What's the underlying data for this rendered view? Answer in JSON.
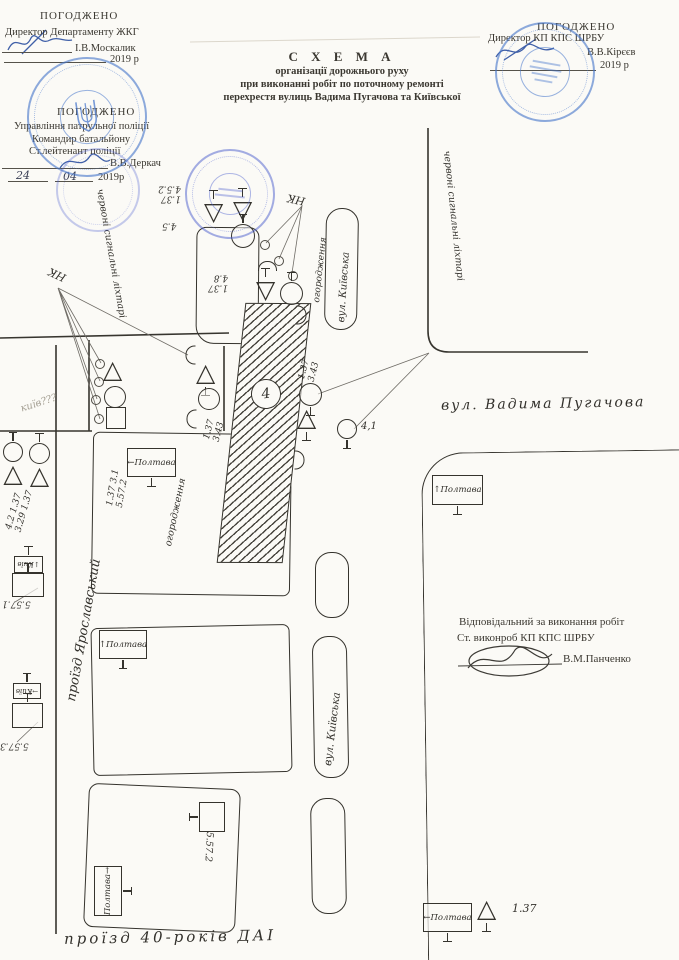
{
  "doc": {
    "approvals": {
      "zhkg": {
        "agreed": "ПОГОДЖЕНО",
        "role": "Директор Департаменту ЖКГ",
        "name": "І.В.Москалик",
        "year": "2019 р"
      },
      "police": {
        "agreed": "ПОГОДЖЕНО",
        "org": "Управління патрульної поліції",
        "role1": "Командир батальйону",
        "role2": "Ст.лейтенант поліції",
        "name": "В.В.Деркач",
        "day": "24",
        "month": "04",
        "year": "2019р"
      },
      "shrbu": {
        "agreed": "ПОГОДЖЕНО",
        "role": "Директор КП КПС ШРБУ",
        "name": "В.В.Кірєєв",
        "year": "2019 р"
      }
    },
    "title": {
      "l1": "С Х Е М А",
      "l2": "організації дорожнього руху",
      "l3": "при виконанні робіт по поточному ремонті",
      "l4": "перехрестя вулиць Вадима Пугачова та Київської"
    },
    "responsible": {
      "l1": "Відповідальний за виконання робіт",
      "l2": "Ст. виконроб КП КПС ШРБУ",
      "name": "В.М.Панченко"
    }
  },
  "streets": {
    "pugachova": "вул. Вадима Пугачова",
    "kyivska_top": "вул. Київська",
    "kyivska_mid": "вул. Київська",
    "yaroslavskyi": "проїзд Ярославський",
    "rokiv40": "проїзд 40-років ДАІ"
  },
  "annotations": {
    "red_lights_left": "червоні сигнальні ліхтарі",
    "red_lights_right": "червоні сигнальні ліхтарі",
    "fence_top": "огородження",
    "fence_left": "огородження",
    "nk_top": "НК",
    "nk_left": "НК",
    "pencil_note": "київ???",
    "zone_number": "4",
    "distance": "4,1"
  },
  "sign_labels": {
    "top_pair": [
      "1.37",
      "4.5.2"
    ],
    "top_circle": "4.5",
    "mid_pair": [
      "1.37",
      "4.8"
    ],
    "right_cluster": [
      "1.37",
      "3.43"
    ],
    "hatch_right": [
      "1.37",
      "3.43"
    ],
    "block_a": [
      "1.37  3.1",
      "5.57.2"
    ],
    "far_left": [
      "4.2  1.37",
      "3.29  1.37"
    ],
    "edge1": "5.57.1",
    "edge2": "5.57.3",
    "block_c": "5.57.2"
  },
  "signs": {
    "poltava_left": "←Полтава",
    "poltava_up_b": "↑Полтава",
    "poltava_up_r": "↑Полтава",
    "poltava_c": "Полтава→",
    "kyiv1": "↓Київ",
    "kyiv2": "→Київ"
  },
  "legend": {
    "poltava": "←Полтава",
    "tri_label": "1.37"
  },
  "colors": {
    "ink": "#35332d",
    "stamp_blue": "#4676cb",
    "signature_blue": "#2b4fa0",
    "paper": "#fbfaf6"
  }
}
